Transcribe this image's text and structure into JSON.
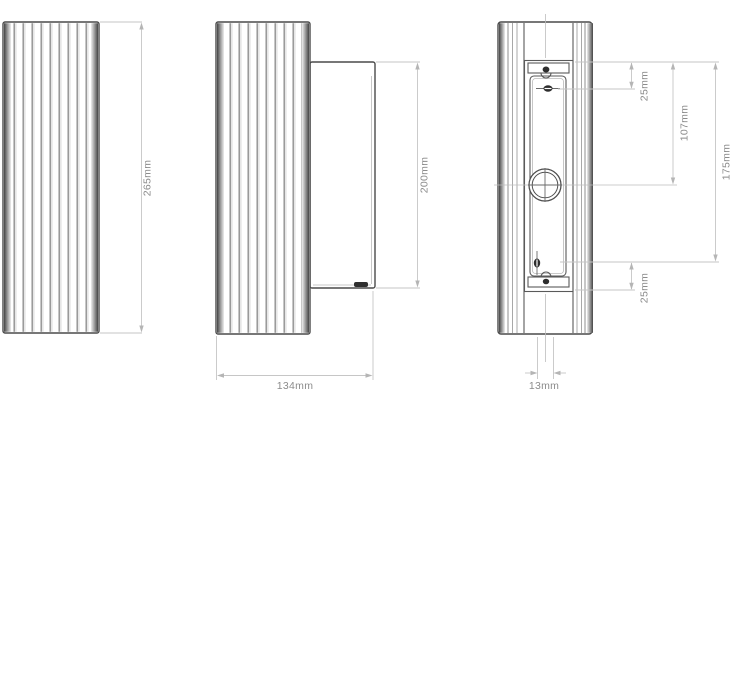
{
  "drawing": {
    "kind": "technical-dimension-drawing",
    "dimensions": {
      "front_height": "265mm",
      "side_height": "200mm",
      "side_width": "134mm",
      "back_top_offset": "25mm",
      "back_center_offset": "107mm",
      "back_mount_span": "175mm",
      "back_bottom_offset": "25mm",
      "back_cable_width": "13mm"
    },
    "colors": {
      "outline": "#4a4a4a",
      "rib_line": "#8f8f8f",
      "dimension_line": "#c6c6c6",
      "dimension_text": "#8c8c8c",
      "background": "#ffffff",
      "brand_mark": "#2f2f2f"
    }
  }
}
